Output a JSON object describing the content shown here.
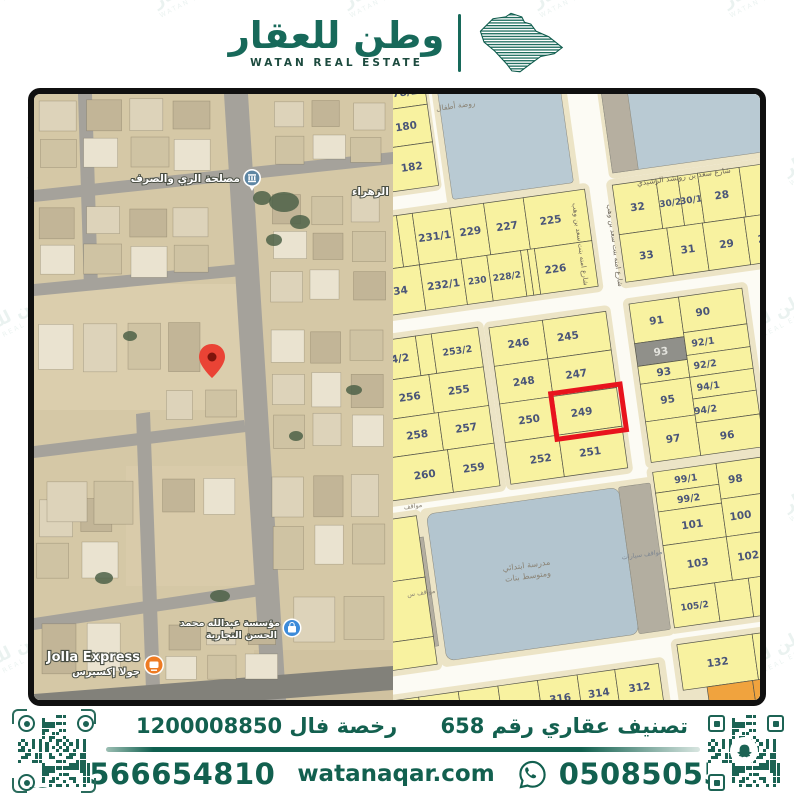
{
  "header": {
    "brand_ar": "وطن للعقار",
    "brand_en": "WATAN REAL ESTATE"
  },
  "watermark": {
    "text_ar": "وطن للعقار",
    "text_en": "WATAN REAL ESTATE"
  },
  "satellite_map": {
    "poi_irrigation": "مصلحة الري والصرف",
    "district": "الزهراء",
    "poi_establishment_line1": "مؤسسة عبدالله محمد",
    "poi_establishment_line2": "الحسن التجارية",
    "poi_jolla_en": "Jolla Express",
    "poi_jolla_ar": "جولا إكسبرس"
  },
  "parcel_map": {
    "highlighted_plot": "249",
    "highlight_color": "#e8131d",
    "colors": {
      "street": "#fcfbf4",
      "sidewalk": "#ece4c6",
      "plot": "#f8f2a0",
      "plot_stroke": "#55554a",
      "number": "#4a5578",
      "blue_area": "#b9cad3",
      "school_blue": "#b3c5cf",
      "gray": "#b3aea0",
      "gray_plot": "#90908a",
      "orange": "#f0a33e"
    },
    "red_box": [
      158,
      296,
      70,
      46
    ],
    "pads": [
      [
        23,
        -45,
        56,
        124
      ],
      [
        82,
        -54,
        134,
        150
      ],
      [
        246,
        -26,
        172,
        118
      ],
      [
        -47,
        92,
        272,
        110
      ],
      [
        242,
        92,
        172,
        110
      ],
      [
        -55,
        214,
        156,
        172
      ],
      [
        101,
        216,
        128,
        170
      ],
      [
        242,
        212,
        126,
        172
      ],
      [
        242,
        382,
        126,
        169
      ],
      [
        12,
        392,
        236,
        160
      ],
      [
        -55,
        392,
        68,
        162
      ],
      [
        242,
        556,
        126,
        98
      ],
      [
        -60,
        572,
        294,
        54
      ]
    ],
    "areas": [
      [
        88,
        -48,
        122,
        138,
        "#b9cad3",
        3
      ],
      [
        250,
        -20,
        162,
        106,
        "#b9cad3",
        2
      ],
      [
        250,
        -20,
        26,
        106,
        "#b6afa0",
        0
      ],
      [
        18,
        398,
        194,
        148,
        "#b3c5cf",
        8
      ],
      [
        212,
        398,
        32,
        148,
        "#b3aea0",
        2
      ],
      [
        -4,
        420,
        16,
        110,
        "#b3aea0",
        0
      ]
    ],
    "plots": [
      [
        "178/2",
        28,
        -38,
        48,
        30
      ],
      [
        "180",
        28,
        -8,
        48,
        38
      ],
      [
        "182",
        28,
        30,
        48,
        44
      ],
      [
        "",
        -42,
        98,
        30,
        52
      ],
      [
        "3",
        -12,
        98,
        42,
        52
      ],
      [
        "",
        30,
        98,
        16,
        52
      ],
      [
        "231/1",
        46,
        98,
        38,
        52
      ],
      [
        "229",
        84,
        98,
        34,
        52
      ],
      [
        "227",
        118,
        98,
        40,
        52
      ],
      [
        "225",
        158,
        98,
        62,
        52,
        {
          "lx": 182
        }
      ],
      [
        "234",
        -42,
        150,
        88,
        46,
        {
          "lx": 20
        }
      ],
      [
        "232/1",
        46,
        150,
        42,
        46
      ],
      [
        "230",
        88,
        150,
        26,
        46,
        {
          "fs": 9
        }
      ],
      [
        "228/2",
        114,
        150,
        34,
        46,
        {
          "fs": 9
        }
      ],
      [
        "",
        148,
        150,
        7,
        46
      ],
      [
        "",
        155,
        150,
        7,
        46
      ],
      [
        "226",
        162,
        150,
        58,
        46,
        {
          "lx": 180
        }
      ],
      [
        "32",
        248,
        98,
        44,
        50
      ],
      [
        "30/2",
        292,
        98,
        22,
        50,
        {
          "fs": 9
        }
      ],
      [
        "30/1",
        314,
        98,
        20,
        50,
        {
          "fs": 9
        }
      ],
      [
        "28",
        334,
        98,
        42,
        50
      ],
      [
        "",
        376,
        98,
        34,
        50
      ],
      [
        "33",
        248,
        148,
        48,
        48
      ],
      [
        "31",
        296,
        148,
        36,
        48
      ],
      [
        "29",
        332,
        148,
        42,
        48
      ],
      [
        "27",
        374,
        148,
        36,
        48
      ],
      [
        "64/2",
        -50,
        220,
        82,
        40,
        {
          "lx": 10
        }
      ],
      [
        "",
        32,
        220,
        16,
        40
      ],
      [
        "253/2",
        48,
        220,
        47,
        40,
        {
          "fs": 9.5
        }
      ],
      [
        "256",
        -50,
        260,
        90,
        39,
        {
          "lx": 18
        }
      ],
      [
        "255",
        40,
        260,
        55,
        39
      ],
      [
        "258",
        -50,
        299,
        94,
        38,
        {
          "lx": 20
        }
      ],
      [
        "257",
        44,
        299,
        51,
        38
      ],
      [
        "260",
        -50,
        337,
        98,
        43,
        {
          "lx": 22
        }
      ],
      [
        "259",
        48,
        337,
        47,
        43
      ],
      [
        "246",
        106,
        222,
        54,
        39
      ],
      [
        "245",
        160,
        222,
        64,
        39,
        {
          "lx": 183
        }
      ],
      [
        "248",
        106,
        261,
        54,
        38
      ],
      [
        "247",
        160,
        261,
        64,
        38,
        {
          "lx": 186
        }
      ],
      [
        "250",
        106,
        299,
        54,
        39
      ],
      [
        "249",
        160,
        299,
        64,
        39,
        {
          "lx": 186
        }
      ],
      [
        "252",
        106,
        338,
        54,
        42,
        {
          "lx": 139
        }
      ],
      [
        "251",
        160,
        338,
        64,
        42,
        {
          "lx": 189
        }
      ],
      [
        "91",
        248,
        218,
        50,
        40
      ],
      [
        "93",
        248,
        258,
        50,
        23,
        {
          "f": "#90908a",
          "c": "#e3e3dd"
        }
      ],
      [
        "93",
        248,
        281,
        50,
        18
      ],
      [
        "95",
        248,
        299,
        50,
        38
      ],
      [
        "97",
        248,
        337,
        50,
        41
      ],
      [
        "90",
        298,
        218,
        64,
        36,
        {
          "lx": 320
        }
      ],
      [
        "92/1",
        298,
        254,
        64,
        23,
        {
          "lx": 316,
          "fs": 9.5
        }
      ],
      [
        "92/2",
        298,
        277,
        64,
        22,
        {
          "lx": 315,
          "fs": 9.5
        }
      ],
      [
        "94/1",
        298,
        299,
        64,
        22,
        {
          "lx": 315,
          "fs": 9.5
        }
      ],
      [
        "94/2",
        298,
        321,
        64,
        24,
        {
          "lx": 309,
          "fs": 9.5
        }
      ],
      [
        "96",
        298,
        345,
        64,
        33,
        {
          "lx": 327
        }
      ],
      [
        "99/1",
        248,
        388,
        64,
        21,
        {
          "fs": 9.5
        }
      ],
      [
        "99/2",
        248,
        409,
        64,
        19,
        {
          "fs": 9.5
        }
      ],
      [
        "101",
        248,
        428,
        64,
        34
      ],
      [
        "103",
        248,
        462,
        64,
        44
      ],
      [
        "105/2",
        248,
        506,
        46,
        39,
        {
          "fs": 9
        }
      ],
      [
        "",
        294,
        506,
        34,
        39
      ],
      [
        "",
        328,
        506,
        34,
        39
      ],
      [
        "98",
        312,
        388,
        50,
        36,
        {
          "lx": 329
        }
      ],
      [
        "100",
        312,
        424,
        50,
        38,
        {
          "lx": 329
        }
      ],
      [
        "102",
        312,
        462,
        50,
        44,
        {
          "lx": 331
        }
      ],
      [
        "",
        -50,
        398,
        58,
        62
      ],
      [
        "",
        -50,
        460,
        58,
        60
      ],
      [
        "",
        -50,
        520,
        58,
        28
      ],
      [
        "132",
        248,
        562,
        76,
        46
      ],
      [
        "13",
        324,
        562,
        38,
        46,
        {
          "lx": 344,
          "ly": 584
        }
      ],
      [
        "",
        272,
        608,
        46,
        40,
        {
          "f": "#f0a33e"
        }
      ],
      [
        "",
        318,
        608,
        44,
        40,
        {
          "f": "#f0a33e"
        }
      ],
      [
        "",
        -55,
        578,
        40,
        42
      ],
      [
        "",
        -15,
        578,
        40,
        42
      ],
      [
        "",
        25,
        578,
        40,
        42
      ],
      [
        "",
        65,
        578,
        40,
        42
      ],
      [
        "316",
        105,
        578,
        40,
        42
      ],
      [
        "314",
        145,
        578,
        38,
        42
      ],
      [
        "312",
        183,
        578,
        44,
        42
      ]
    ],
    "labels": [
      [
        "شارع سعد بن رويشد الرشيدي",
        320,
        102,
        7.5,
        0,
        "#6e675a"
      ],
      [
        "شارع امنه بنت سعد بن وهب",
        206,
        152,
        7,
        90,
        "#6e675a"
      ],
      [
        "شارع امنه بنت سعد بن وهب",
        240,
        158,
        7,
        90,
        "#6e675a"
      ],
      [
        "روضة أطفال",
        104,
        0,
        7.5,
        0,
        "#8a8375"
      ],
      [
        "مدرسة ابتدائي",
        110,
        465,
        8,
        0,
        "#8a8375"
      ],
      [
        "ومتوسط بنات",
        110,
        476,
        8,
        0,
        "#8a8375"
      ],
      [
        "مواقف سيارات",
        226,
        470,
        6.5,
        0,
        "#7d8691"
      ],
      [
        "مواقف",
        6,
        390,
        6.5,
        0,
        "#8a8375"
      ],
      [
        "مواقف س",
        2,
        477,
        6.5,
        0,
        "#8a8375"
      ]
    ]
  },
  "footer": {
    "classification_label": "تصنيف عقاري رقم 658",
    "license_label": "رخصة فال 1200008850",
    "phone_left": "0566654810",
    "phone_right": "0508505505",
    "website": "watanaqar.com"
  }
}
